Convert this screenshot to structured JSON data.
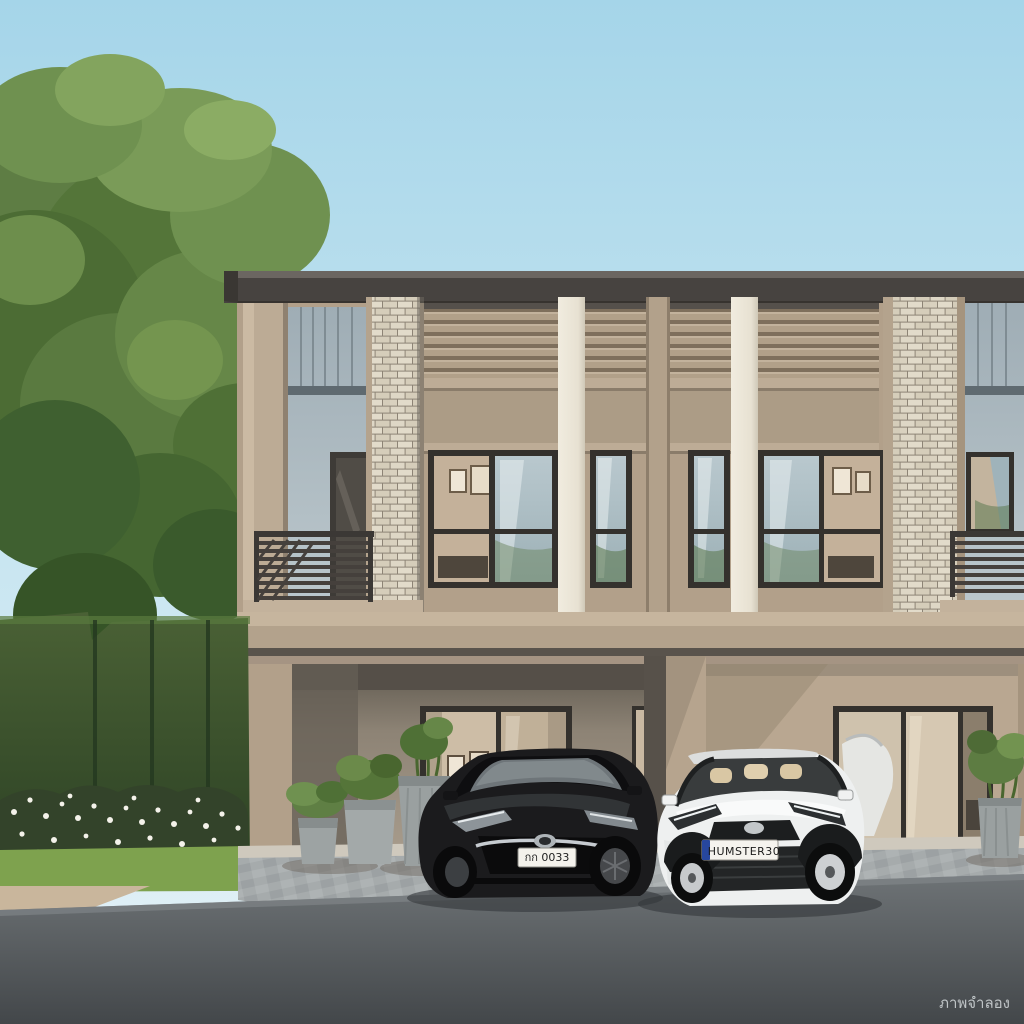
{
  "scene": {
    "type": "architectural-rendering",
    "watermark": "ภาพจำลอง",
    "cars": {
      "black_car_plate": "กก 0033",
      "white_car_plate": "HUMSTER30"
    },
    "palette": {
      "sky_top": "#a9d7ea",
      "sky_bottom": "#e3f1f7",
      "wall_tan": "#b2a08a",
      "pilaster_cream": "#eee9dc",
      "brick_light": "#ddd5c3",
      "panel_gray": "#a9b6bd",
      "roof_dark": "#474340",
      "window_frame": "#34312d",
      "foliage_green": "#5d7c42",
      "hedge_green": "#3f5530",
      "asphalt": "#5d6265",
      "paver_gray": "#a6abac"
    }
  }
}
